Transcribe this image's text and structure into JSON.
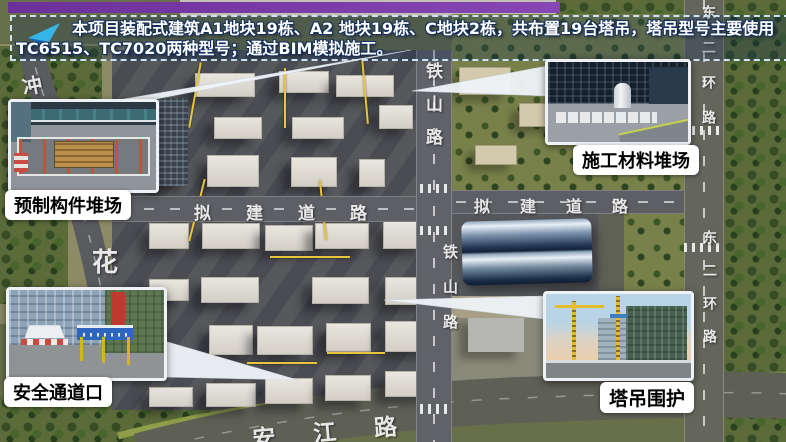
{
  "header": {
    "icon": "paper-plane-arrow-icon",
    "lines": [
      "本项目装配式建筑A1地块19栋、A2 地块19栋、C地块2栋，共布置19台塔吊，塔吊型号主要使用",
      "TC6515、TC7020两种型号；通过BIM模拟施工。"
    ]
  },
  "callouts": [
    {
      "id": "prefab-component-yard",
      "label": "预制构件堆场"
    },
    {
      "id": "construction-material-yard",
      "label": "施工材料堆场"
    },
    {
      "id": "safety-passage-entrance",
      "label": "安全通道口"
    },
    {
      "id": "tower-crane-enclosure",
      "label": "塔吊围护"
    }
  ],
  "map": {
    "road_labels": {
      "tieshan_north": "铁山路",
      "tieshan_south": "铁山路",
      "proposed_road_west": "拟建道路",
      "proposed_road_east": "拟建道路",
      "east_second_ring_north": "东二环路",
      "east_second_ring_south": "东二环路",
      "anjiang_road": "安江路",
      "hua_char": "花",
      "chong_char": "冲"
    }
  },
  "colors": {
    "top_bar": "#7c3ca8",
    "info_border": "#cfe2f4",
    "arrow_cyan": "#35b5ea",
    "label_bg": "#ffffff",
    "label_text": "#000000",
    "road_paint": "#ffffff",
    "crane_yellow": "#e8c33c"
  }
}
